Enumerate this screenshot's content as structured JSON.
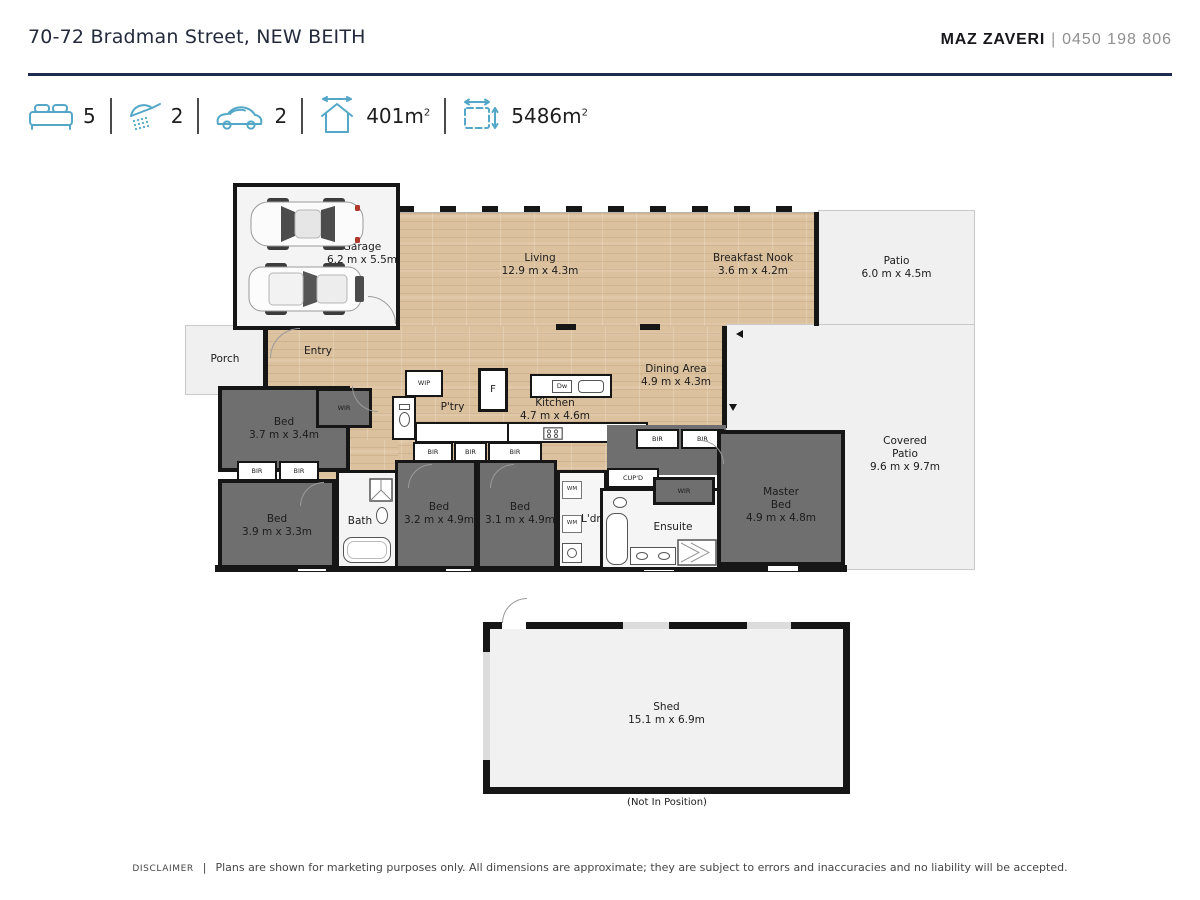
{
  "header": {
    "address": "70-72 Bradman Street, NEW BEITH",
    "agent_name": "MAZ ZAVERI",
    "agent_sep": "|",
    "agent_phone": "0450 198 806"
  },
  "stats": {
    "beds": "5",
    "showers": "2",
    "cars": "2",
    "house_area": "401",
    "land_area": "5486",
    "area_unit": "m",
    "sup": "2"
  },
  "rooms": {
    "garage": {
      "name": "Garage",
      "dims": "6.2 m x 5.5m"
    },
    "living": {
      "name": "Living",
      "dims": "12.9 m x 4.3m"
    },
    "breakfast": {
      "name": "Breakfast Nook",
      "dims": "3.6 m x 4.2m"
    },
    "patio": {
      "name": "Patio",
      "dims": "6.0 m x 4.5m"
    },
    "porch": {
      "name": "Porch"
    },
    "entry": {
      "name": "Entry"
    },
    "dining": {
      "name": "Dining Area",
      "dims": "4.9 m x 4.3m"
    },
    "kitchen": {
      "name": "Kitchen",
      "dims": "4.7 m x 4.6m"
    },
    "bed1": {
      "name": "Bed",
      "dims": "3.7 m x 3.4m"
    },
    "bed2": {
      "name": "Bed",
      "dims": "3.9 m x 3.3m"
    },
    "bed3": {
      "name": "Bed",
      "dims": "3.2 m x 4.9m"
    },
    "bed4": {
      "name": "Bed",
      "dims": "3.1 m x 4.9m"
    },
    "master": {
      "l1": "Master",
      "l2": "Bed",
      "dims": "4.9 m x 4.8m"
    },
    "covered_patio": {
      "l1": "Covered",
      "l2": "Patio",
      "dims": "9.6 m x 9.7m"
    },
    "shed": {
      "name": "Shed",
      "dims": "15.1 m x 6.9m",
      "note": "(Not In Position)"
    }
  },
  "labels": {
    "bath": "Bath",
    "ensuite": "Ensuite",
    "ldry": "L'dry",
    "ptry": "P'try",
    "wip": "WIP",
    "wir": "WIR",
    "bir": "BIR",
    "wm": "WM",
    "cupd": "CUP'D",
    "fridge": "F",
    "dw": "Dw"
  },
  "disclaimer": {
    "label": "DISCLAIMER",
    "sep": "|",
    "text": "Plans are shown for marketing purposes only. All dimensions are approximate; they are subject to errors and inaccuracies and no liability will be accepted."
  },
  "colors": {
    "accent_blue": "#54a7c7",
    "navy_rule": "#1d2b4e",
    "wood": "#dcc19e",
    "dark_room": "#6f6f6f",
    "light_room": "#f0f0f0",
    "wall": "#161616"
  }
}
